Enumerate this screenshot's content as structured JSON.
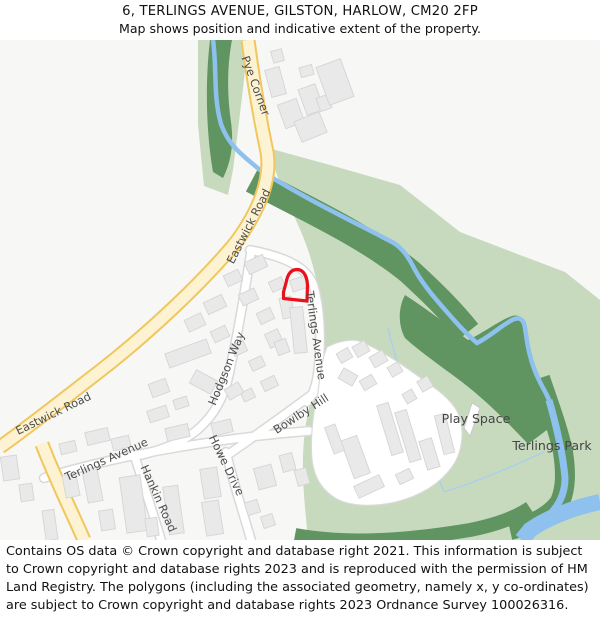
{
  "header": {
    "title": "6, TERLINGS AVENUE, GILSTON, HARLOW, CM20 2FP",
    "subtitle": "Map shows position and indicative extent of the property."
  },
  "map": {
    "road_labels": [
      {
        "id": "pye-corner",
        "text": "Pye Corner"
      },
      {
        "id": "eastwick-road-upper",
        "text": "Eastwick Road"
      },
      {
        "id": "eastwick-road-lower",
        "text": "Eastwick Road"
      },
      {
        "id": "terlings-avenue-north",
        "text": "Terlings Avenue"
      },
      {
        "id": "hodgson-way",
        "text": "Hodgson Way"
      },
      {
        "id": "bowlby-hill",
        "text": "Bowlby Hill"
      },
      {
        "id": "howe-drive",
        "text": "Howe Drive"
      },
      {
        "id": "hankin-road",
        "text": "Hankin Road"
      },
      {
        "id": "terlings-avenue-south",
        "text": "Terlings Avenue"
      }
    ],
    "area_labels": [
      {
        "id": "play-space",
        "text": "Play Space"
      },
      {
        "id": "terlings-park",
        "text": "Terlings Park"
      }
    ],
    "colors": {
      "bg": "#f7f7f5",
      "park": "#c7dabe",
      "woodland": "#609562",
      "river": "#8ec1ee",
      "stream": "#a9cfec",
      "road_a_fill": "#fdf3d2",
      "road_a_casing": "#f0c75f",
      "road_fill": "#ffffff",
      "road_casing": "#d9d9d9",
      "building": "#e9e9e9",
      "building_stroke": "#d5d5d5",
      "plot": "#e8111c",
      "label": "#4d4d4d",
      "area_label": "#454545"
    }
  },
  "footer": {
    "attribution": "Contains OS data © Crown copyright and database right 2021. This information is subject to Crown copyright and database rights 2023 and is reproduced with the permission of HM Land Registry. The polygons (including the associated geometry, namely x, y co-ordinates) are subject to Crown copyright and database rights 2023 Ordnance Survey 100026316."
  }
}
